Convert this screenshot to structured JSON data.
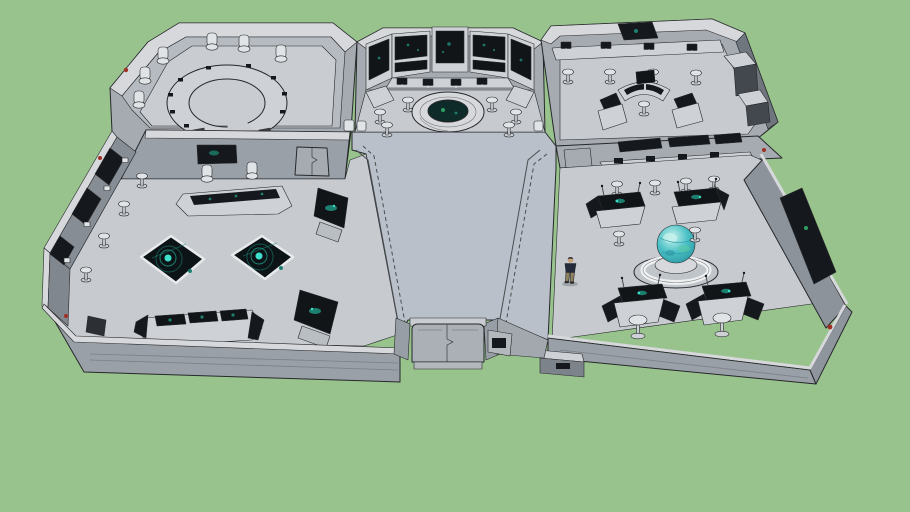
{
  "scene": {
    "kind": "3d-model-screenshot",
    "subject": "sci-fi command center interior model viewed from above on plain green backdrop",
    "rooms": [
      {
        "label": "conference-room",
        "position": "top-left"
      },
      {
        "label": "command-center",
        "position": "top-center"
      },
      {
        "label": "monitoring-room",
        "position": "top-right"
      },
      {
        "label": "operations-room",
        "position": "left"
      },
      {
        "label": "globe-room",
        "position": "right"
      },
      {
        "label": "entrance-corridor",
        "position": "bottom-center"
      }
    ],
    "props": [
      "c-shaped-conference-table",
      "conference-chairs",
      "wall-screen-bay",
      "holo-ring-platform",
      "tactical-floor-display",
      "tactical-floor-display",
      "wall-console-banks",
      "tilted-wall-screens",
      "desk-consoles",
      "stools",
      "holo-globe",
      "globe-pedestal",
      "globe-workstations",
      "divider-window-wall",
      "side-wall-screen",
      "entrance-door",
      "low-cabinet",
      "standing-person",
      "red-indicator-lights",
      "green-indicator-light"
    ]
  },
  "palette": {
    "background": "#99c38d",
    "edge": "#26282b",
    "seam": "#7a8086",
    "rail": "#4a4d51",
    "wall_top": "#d6d8db",
    "wall_outer": "#a6abb2",
    "wall_inner": "#b6bbc1",
    "wall_bevel": "#70767d",
    "wall_front": "#9aa0a7",
    "floor_room": "#c7cbd0",
    "floor_hall": "#b9c0c9",
    "floor_conference": "#c9cdd2",
    "panel_dark": "#15181c",
    "screen_dark": "#121518",
    "metal_light": "#ced2d6",
    "chair_light": "#e1e4e7",
    "chair_dark": "#3c4147",
    "glow_teal": "#3fe0cb",
    "glow_dim": "#1d7f6f",
    "globe_main": "#49c0c6",
    "globe_light": "#c8f2ec",
    "globe_deep": "#2f9aa5",
    "red_indicator": "#a03024",
    "green_indicator": "#2e9e62",
    "person_shirt": "#252b3a",
    "person_pants": "#8f825e",
    "person_skin": "#c8a37e",
    "person_hair": "#2e2e2e"
  }
}
